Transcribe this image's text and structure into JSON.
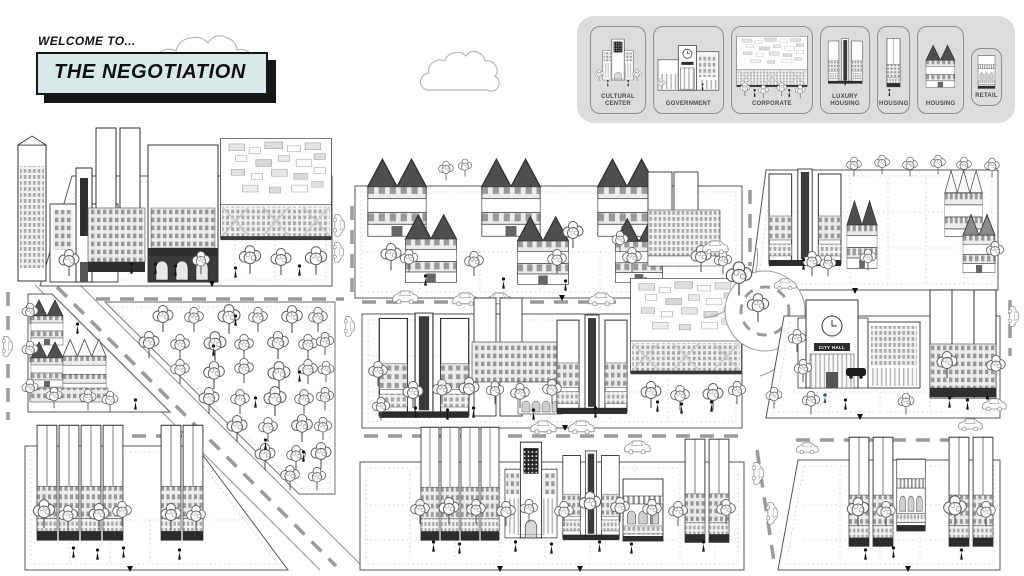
{
  "header": {
    "welcome_label": "WELCOME TO...",
    "title": "THE NEGOTIATION"
  },
  "legend": {
    "items": [
      {
        "id": "cultural-center",
        "label": "CULTURAL CENTER"
      },
      {
        "id": "government",
        "label": "GOVERNMENT"
      },
      {
        "id": "corporate",
        "label": "CORPORATE"
      },
      {
        "id": "luxury-housing",
        "label": "LUXURY HOUSING"
      },
      {
        "id": "housing-tower",
        "label": "HOUSING"
      },
      {
        "id": "housing-gabled",
        "label": "HOUSING"
      },
      {
        "id": "retail",
        "label": "RETAIL"
      }
    ]
  },
  "map": {
    "city_hall_sign": "CITY HALL"
  },
  "colors": {
    "title_box_bg": "#d7eae9",
    "title_shadow": "#161616",
    "legend_bg": "#dcdcdc",
    "card_border": "#8d8d8d",
    "roof_dark": "#4e4e4e",
    "ink": "#333333",
    "road_dash": "#9a9a9a"
  }
}
